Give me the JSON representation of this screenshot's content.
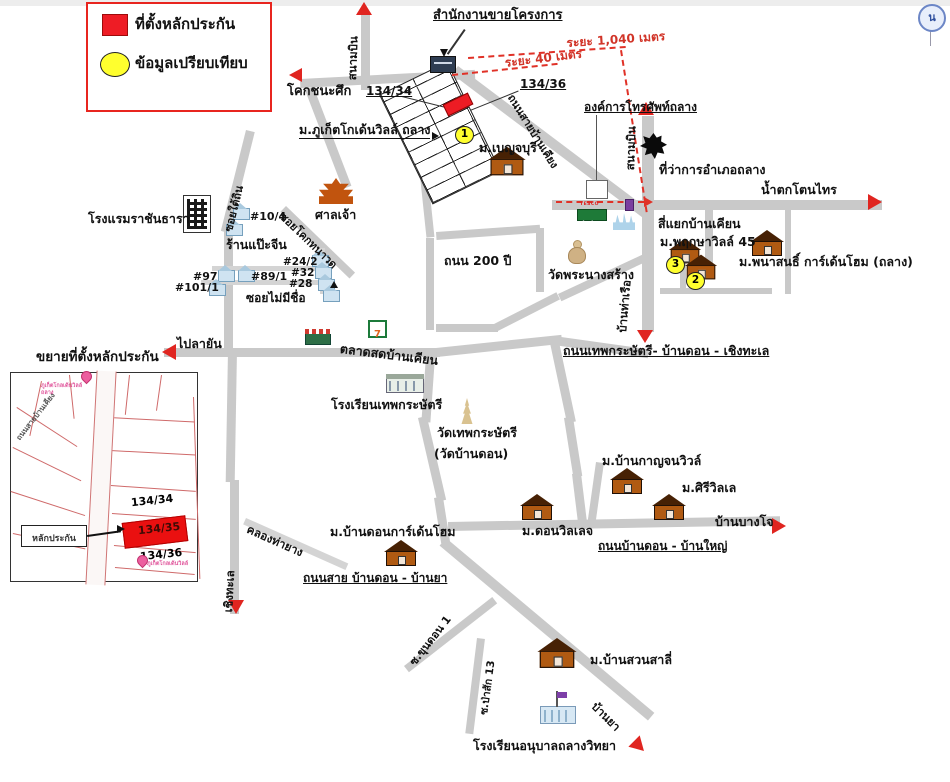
{
  "legend": {
    "collateral_label": "ที่ตั้งหลักประกัน",
    "comparison_label": "ข้อมูลเปรียบเทียบ"
  },
  "compass_n": "น",
  "measurements": {
    "d1040": "ระยะ 1,040 เมตร",
    "d40": "ระยะ 40 เมตร"
  },
  "top": {
    "sales_office": "สำนักงานขายโครงการ",
    "airport_left": "สนามบิน",
    "airport_right": "สนามบิน",
    "khok_chana_suek": "โคกชนะศึก",
    "lot_134_34": "134/34",
    "lot_134_36": "134/36",
    "project": "ม.ภูเก็ตโกเด้นวิลล์ ถลาง",
    "benjaburi": "ม.เบญจบุรี",
    "ban_khian_road": "ถนนสายบ้านเคียง",
    "phone_org": "องค์การโทรศัพท์ถลาง",
    "district_office": "ที่ว่าการอำเภอถลาง",
    "waterfall": "น้ำตกโตนไทร"
  },
  "mid": {
    "intersection": "สี่แยกบ้านเคียน",
    "pruksa": "ม.พฤกษาวิลล์ 45",
    "panasont": "ม.พนาสนธิ์ การ์เด้นโฮม (ถลาง)",
    "wat_phra_nang_sang": "วัดพระนางสร้าง",
    "road_200": "ถนน 200 ปี",
    "thep_road": "ถนนเทพกระษัตรี- บ้านดอน - เชิงทะเล",
    "ban_tha_ruea": "บ้านท่าเรือ",
    "marker1": "1",
    "marker2": "2",
    "marker3": "3"
  },
  "left": {
    "hotel": "โรงแรมราชันธารา",
    "soi_tai_thin": "ซอยใต้ถิน",
    "no_10_4": "#10/4",
    "chinese_shop": "ร้านแป๊ะจีน",
    "soi_khok": "ซอยโคกทนาวด",
    "no_24_2": "#24/2",
    "no_32": "#32",
    "no_28": "#28",
    "no_97": "#97",
    "no_89_1": "#89/1",
    "no_101_1": "#101/1",
    "soi_no_name": "ซอยไม่มีชื่อ",
    "shrine": "ศาลเจ้า",
    "to_layan": "ไปลายัน",
    "market": "ตลาดสดบ้านเคียน"
  },
  "south": {
    "school_thep": "โรงเรียนเทพกระษัตรี",
    "wat_thep_line1": "วัดเทพกระษัตรี",
    "wat_thep_line2": "(วัดบ้านดอน)",
    "kanchana": "ม.บ้านกาญจนวิวล์",
    "siri": "ม.ศิรีวิลเล",
    "ban_bang_jo": "บ้านบางโจ",
    "don_village": "ม.ดอนวิลเลจ",
    "ban_don_yai_road": "ถนนบ้านดอน - บ้านใหญ่",
    "ban_don_gh": "ม.บ้านดอนการ์เด้นโฮม",
    "ban_don_ya_road": "ถนนสาย บ้านดอน - บ้านยา",
    "khlong": "คลองท่ายาง",
    "cherngtalay": "เชิงทะเล",
    "soi_khun_don": "ซ.ขุนดอน 1",
    "soi_pa_sak": "ซ.ป่าสัก 13",
    "suan_salee": "ม.บ้านสวนสาลี่",
    "anuban_school": "โรงเรียนอนุบาลถลางวิทยา",
    "ban_ya": "บ้านยา"
  },
  "inset": {
    "title": "ขยายที่ตั้งหลักประกัน",
    "lot_134_34": "134/34",
    "lot_134_35": "134/35",
    "lot_134_36": "134/36",
    "collateral_box": "หลักประกัน",
    "road_label": "ถนนสายบ้านเคียง",
    "pin_top_text": "ภูเก็ตโกลเด้นวิลล์ ถลาง",
    "pin_bottom_text": "ภูเก็ตโกลเด้นวิลล์"
  },
  "icons": {
    "seven": "7",
    "tesco": "TESCO",
    "lotus": "Lotus"
  },
  "colors": {
    "collateral_red": "#ee1c25",
    "comparison_yellow": "#ffff2e",
    "measure_red": "#d13428",
    "road_gray": "#c9c9c9"
  }
}
